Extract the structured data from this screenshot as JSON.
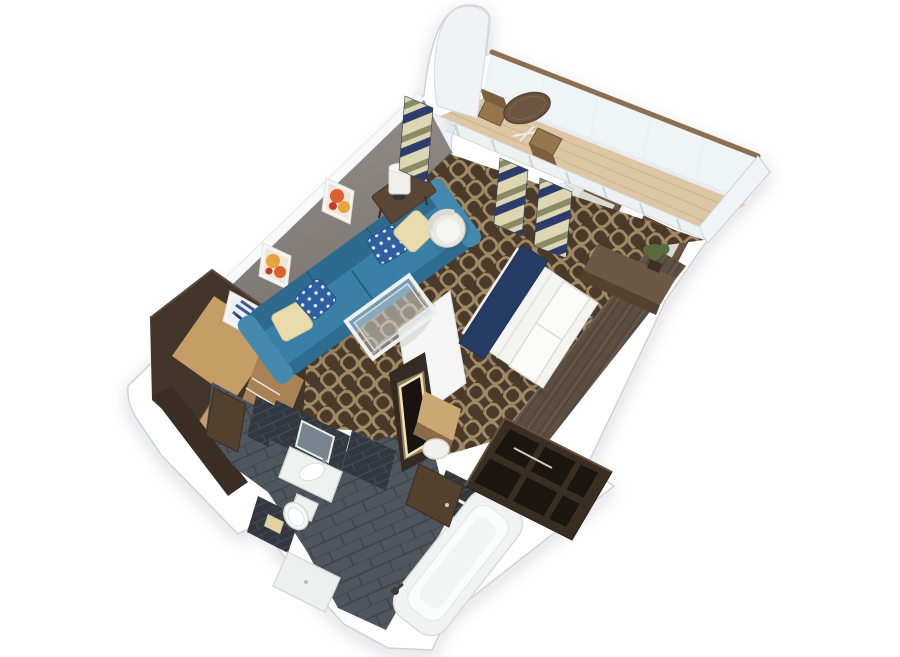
{
  "scene": {
    "type": "3d-rendered-floorplan",
    "subject": "stateroom-suite-with-balcony",
    "regions": [
      "balcony",
      "living-area",
      "bedroom",
      "vanity",
      "bathroom",
      "entry-hall",
      "closet"
    ]
  },
  "colors": {
    "background": "#ffffff",
    "wall_white": "#f1f4f6",
    "wall_edge": "#ccd2d7",
    "gray_wall": "#948f8a",
    "gray_wall_dark": "#797470",
    "balcony_wood": "#dcc6a4",
    "balcony_plank": "#c8b18c",
    "rail_wood": "#8a6f52",
    "glass_tint": "rgba(203,217,228,0.30)",
    "carpet_base": "#4b3a2a",
    "carpet_ring": "#a08a65",
    "tile_floor": "#50565d",
    "tile_line": "#3e444b",
    "tile_wall": "#33383f",
    "tile_wall_line": "#474d55",
    "sofa": "#3a80a6",
    "sofa_dark": "#2d6a8e",
    "sofa_light": "#4489ae",
    "pillow_cream": "#eadcaa",
    "pillow_blue": "#2e5f9f",
    "wood_light": "#c59e66",
    "wood_mid": "#a88154",
    "wood_dark": "#4c3b2c",
    "headboard": "#5c4e41",
    "bed_white": "#f4f4f1",
    "runner_navy": "#243c66",
    "fixture": "#f0f2f2",
    "fixture_edge": "#d5dada",
    "art_orange": "#dd6130",
    "art_yellow": "#e7a43c",
    "art_red": "#bf3c2b",
    "art_blue": "#3e5a90",
    "art_navy": "#22396b",
    "curtain_cream": "#ddd6b2",
    "curtain_olive": "#8b8a67",
    "curtain_navy": "#2d3c6a",
    "mirror_glow": "#f3e2ae",
    "mirror_glass": "#77848f",
    "plant": "#5a6b3f",
    "lamp_base": "#35373c"
  }
}
